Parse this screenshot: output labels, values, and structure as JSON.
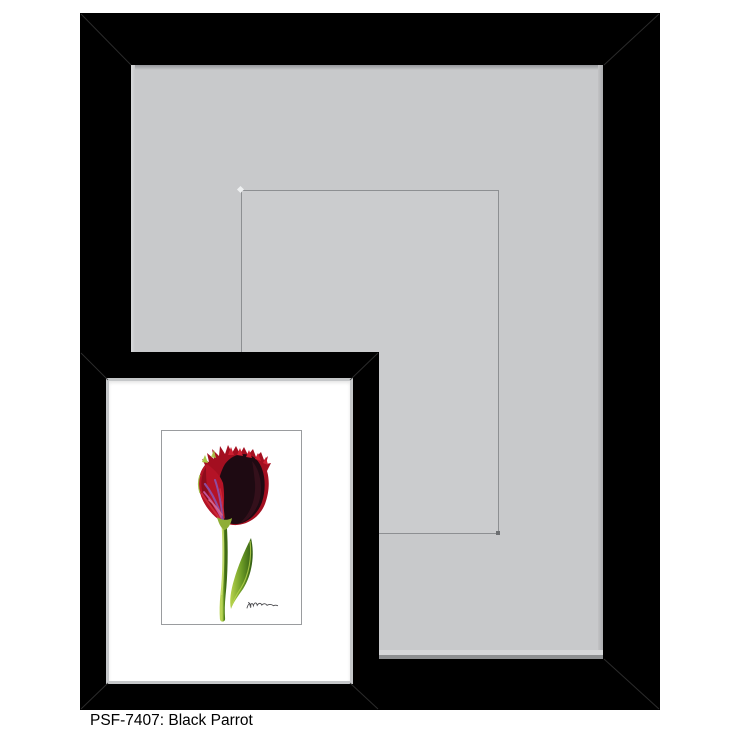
{
  "caption": {
    "text": "PSF-7407: Black Parrot",
    "sku": "PSF-7407",
    "product_name": "Black Parrot"
  },
  "scene": {
    "background_color": "#ffffff",
    "large_frame": {
      "frame_color": "#000000",
      "mat_color": "#c8c9cb",
      "groove_line_color": "#8d8f92",
      "role": "black display frame with gray mat and v-groove opening"
    },
    "small_frame": {
      "frame_color": "#000000",
      "lip_color": "#c5c7c9",
      "mat_color": "#ffffff",
      "print_border_color": "#9a9c9f",
      "role": "inset framed print preview"
    },
    "artwork": {
      "subject": "black parrot tulip botanical illustration",
      "signature": "artist-signature-squiggle",
      "colors": {
        "petal_red": "#ad1022",
        "petal_bright_red": "#cc1f31",
        "petal_dark": "#1e0a12",
        "feather_purple": "#8d50aa",
        "feather_magenta": "#c75aa4",
        "stem_green": "#6b9727",
        "leaf_light_green": "#a9c746"
      }
    }
  }
}
